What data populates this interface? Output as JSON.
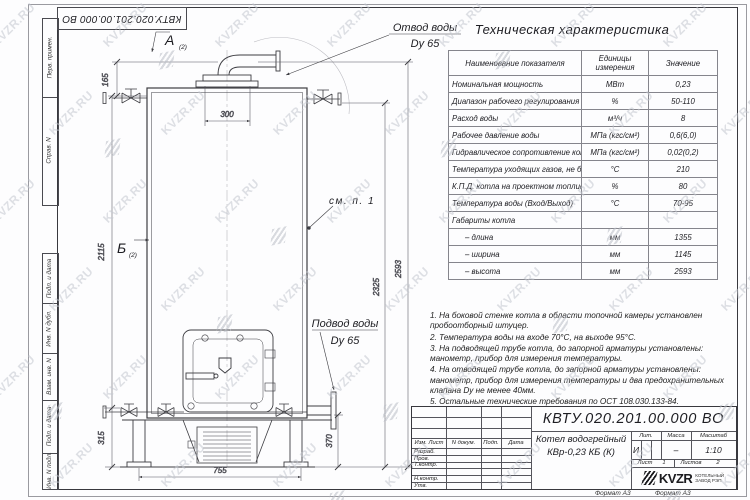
{
  "watermark": {
    "text": "KVZR.RU"
  },
  "frame": {
    "margin_labels": [
      "Перв. примен.",
      "Справ. N",
      "Подп. и дата",
      "Инв. N дубл.",
      "Взам. инв. N",
      "Подп. и дата",
      "Инв. N подл."
    ],
    "top_doc_number": "КВТУ.020.201.00.000 ВО",
    "format_left": "Формат А3",
    "format_right": "Формат А3"
  },
  "drawing": {
    "view_a": "А",
    "view_a_sub": "(2)",
    "view_b": "Б",
    "view_b_sub": "(2)",
    "outlet_line1": "Отвод воды",
    "outlet_line2": "Dy 65",
    "inlet_line1": "Подвод воды",
    "inlet_line2": "Dy 65",
    "see_note": "см. п. 1",
    "dims": {
      "w300": "300",
      "w755": "755",
      "h165": "165",
      "h2115": "2115",
      "h315": "315",
      "h370": "370",
      "h2325": "2325",
      "h2593": "2593"
    }
  },
  "spec_table": {
    "title": "Техническая характеристика",
    "col_headers": [
      "Наименование показателя",
      "Единицы измерения",
      "Значение"
    ],
    "rows": [
      [
        "Номинальная мощность",
        "МВт",
        "0,23"
      ],
      [
        "Диапазон рабочего регулирования",
        "%",
        "50-110"
      ],
      [
        "Расход воды",
        "м³/ч",
        "8"
      ],
      [
        "Рабочее давление воды",
        "МПа (кгс/см²)",
        "0,6(6,0)"
      ],
      [
        "Гидравлическое сопротивление котла",
        "МПа (кгс/см²)",
        "0,02(0,2)"
      ],
      [
        "Температура уходящих газов, не более",
        "°С",
        "210"
      ],
      [
        "К.П.Д. котла на проектном топливе",
        "%",
        "80"
      ],
      [
        "Температура воды (Вход/Выход)",
        "°С",
        "70-95"
      ],
      [
        "Габариты котла",
        "",
        ""
      ],
      [
        "– длина",
        "мм",
        "1355"
      ],
      [
        "– ширина",
        "мм",
        "1145"
      ],
      [
        "– высота",
        "мм",
        "2593"
      ]
    ]
  },
  "notes": [
    "1. На боковой стенке котла в области топочной камеры установлен пробоотборный штуцер.",
    "2. Температура воды на входе 70°С, на выходе 95°С.",
    "3. На подводящей трубе котла, до запорной арматуры установлены: манометр, прибор для измерения температуры.",
    "4. На отводящей трубе котла, до запорной арматуры установлены: манометр, прибор для измерения температуры и два предохранительных клапана Dу не менее 40мм.",
    "5. Остальные технические требования по ОСТ 108.030.133-84."
  ],
  "title_block": {
    "doc_number": "КВТУ.020.201.00.000 ВО",
    "product_line1": "Котел водогрейный",
    "product_line2": "КВр-0,23 КБ (К)",
    "cols": [
      "Изм. Лист",
      "N докум.",
      "Подп.",
      "Дата"
    ],
    "roles": [
      "Разраб.",
      "Пров.",
      "Т.контр.",
      "Н.контр.",
      "Утв."
    ],
    "lit_label": "Лит.",
    "lit_value": "И",
    "mass_label": "Масса",
    "mass_value": "–",
    "scale_label": "Масштаб",
    "scale_value": "1:10",
    "sheet_label": "Лист",
    "sheet_value": "1",
    "sheets_label": "Листов",
    "sheets_value": "2",
    "logo_text": "KVZR",
    "company_line1": "КОТЕЛЬНЫЙ",
    "company_line2": "ЗАВОД РЭП"
  }
}
